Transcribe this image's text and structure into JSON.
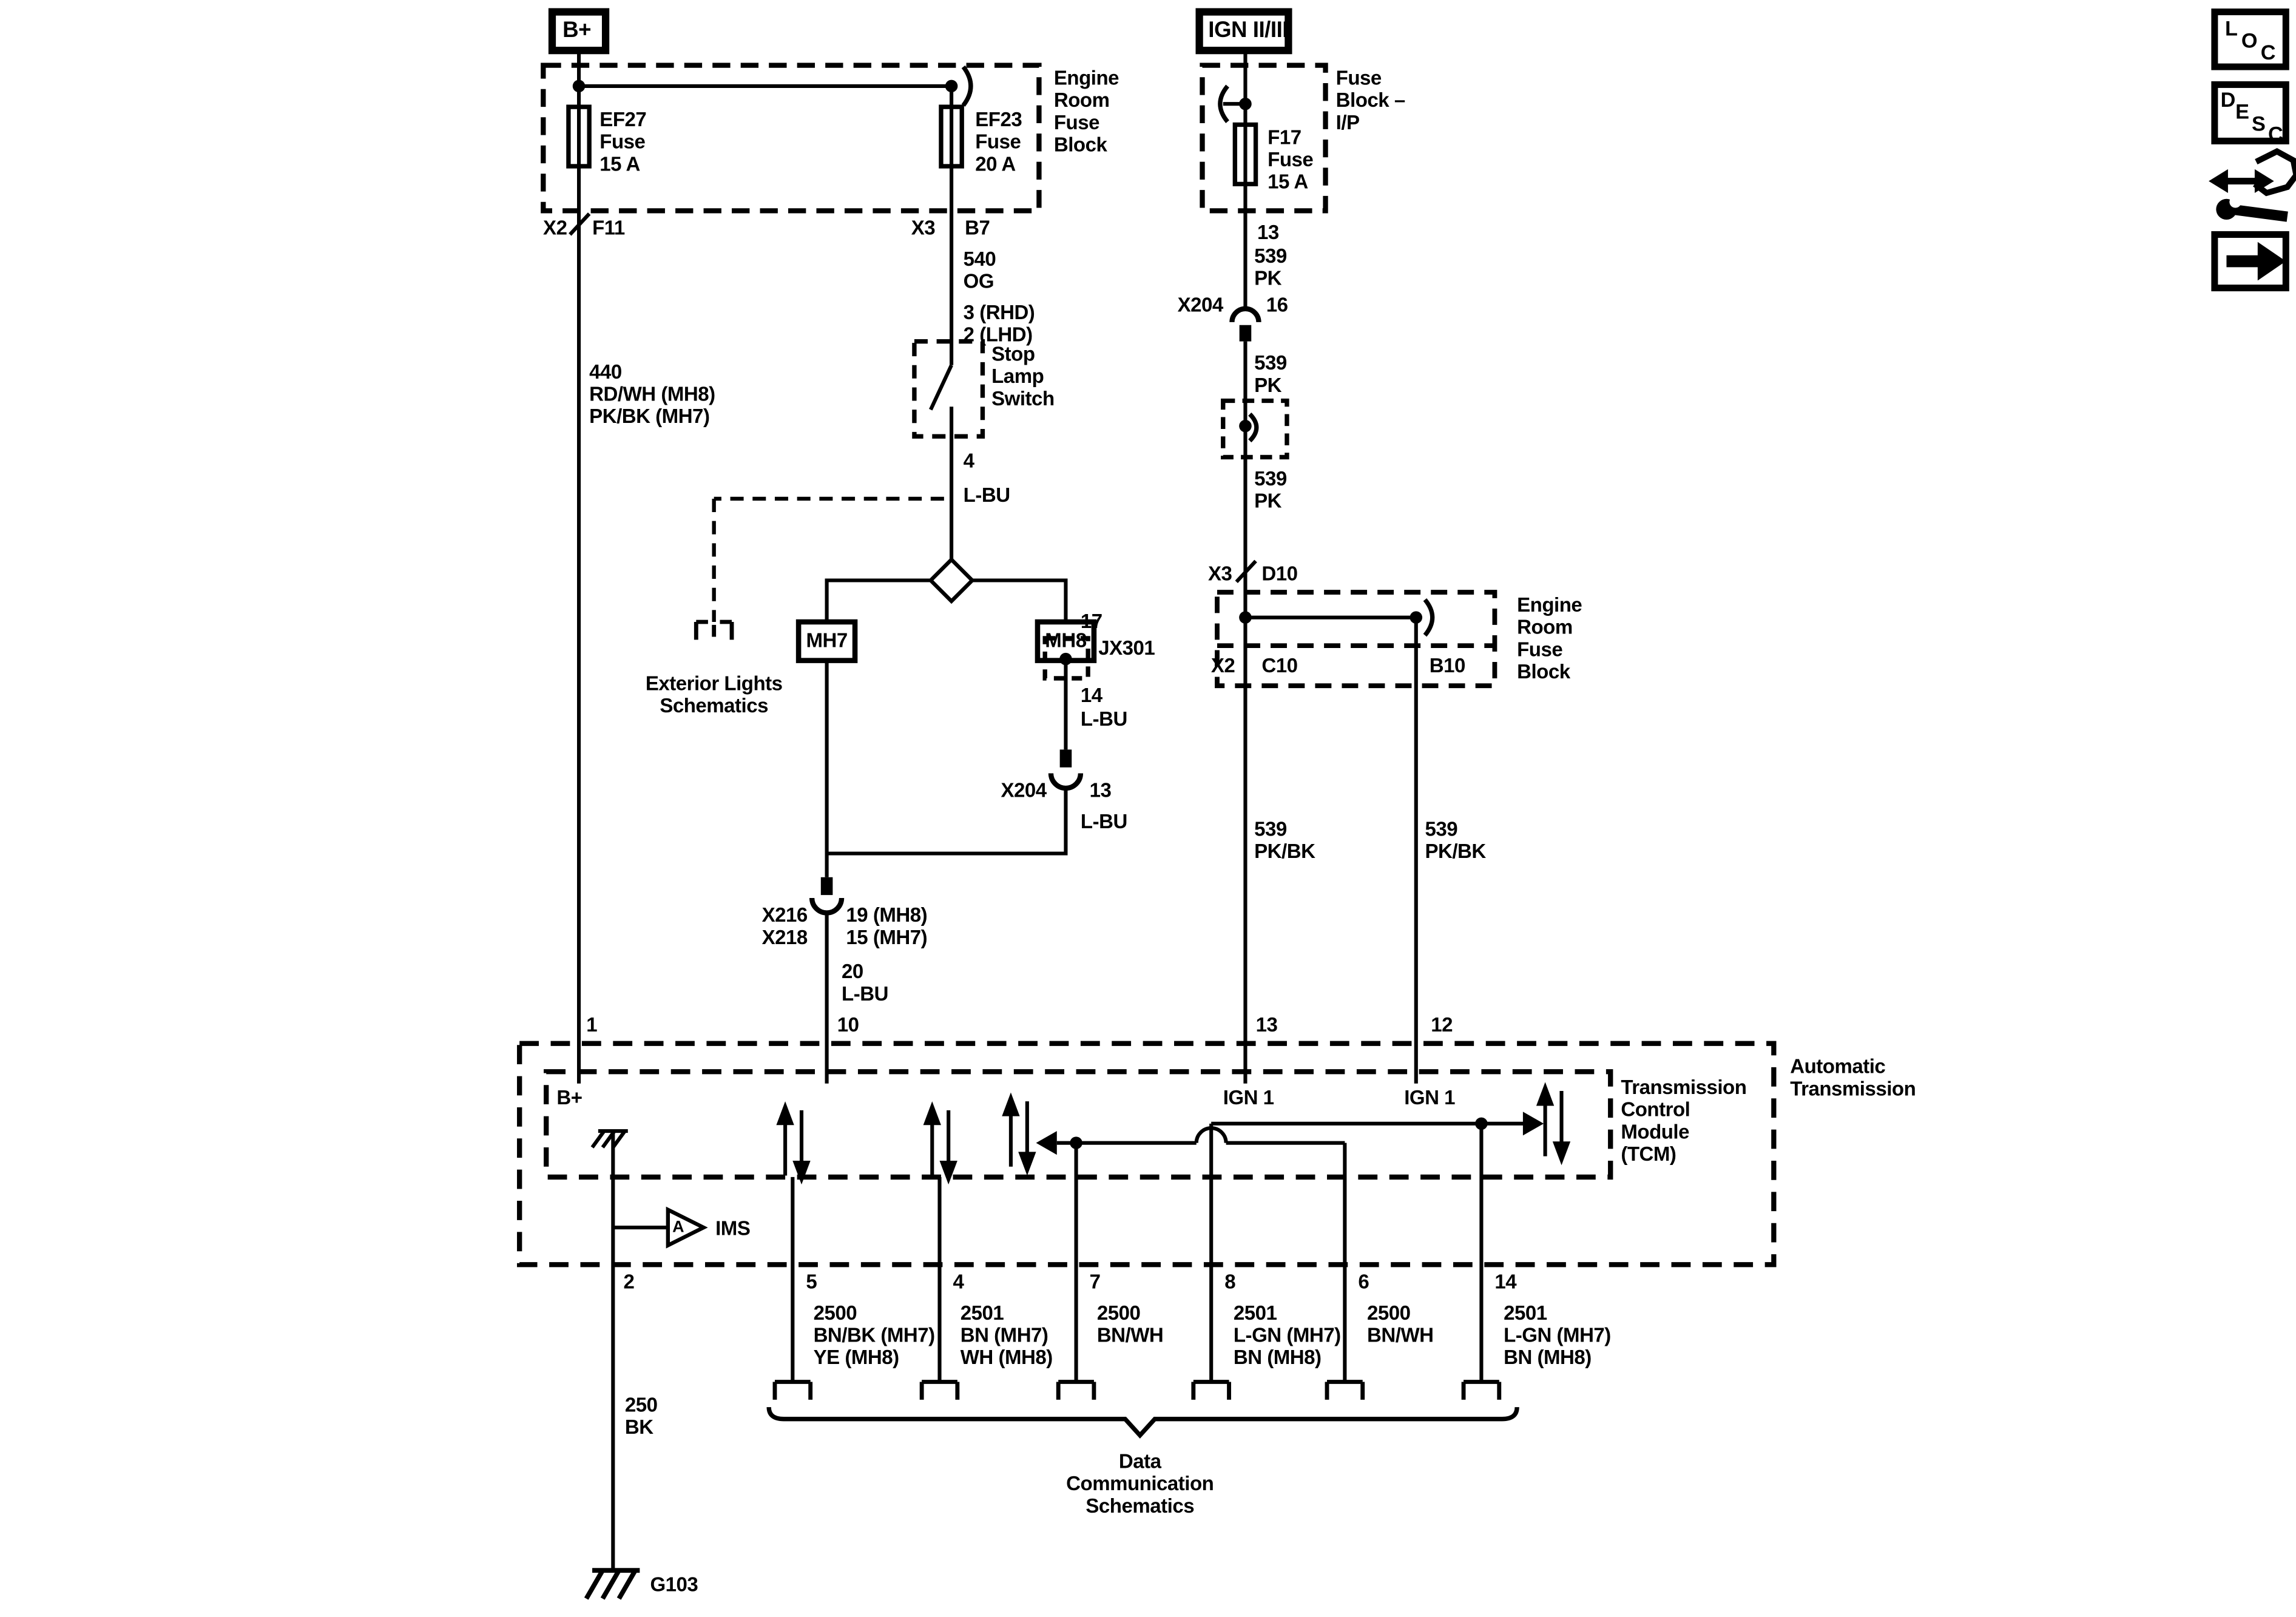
{
  "colors": {
    "line": "#000000",
    "background": "#ffffff"
  },
  "power": {
    "b_plus": "B+",
    "ign": "IGN II/III"
  },
  "engine_room_fuse_block_top": {
    "name": "Engine\nRoom\nFuse\nBlock",
    "ef27": "EF27\nFuse\n15 A",
    "ef23": "EF23\nFuse\n20 A",
    "x2": "X2",
    "f11": "F11",
    "x3": "X3",
    "b7": "B7"
  },
  "fuse_block_ip": {
    "name": "Fuse\nBlock –\nI/P",
    "f17": "F17\nFuse\n15 A",
    "pin13": "13",
    "wire539pk_a": "539\nPK",
    "x204": "X204",
    "pin16": "16",
    "wire539pk_b": "539\nPK",
    "wire539pk_c": "539\nPK",
    "x3": "X3",
    "d10": "D10"
  },
  "engine_room_fuse_block_right": {
    "name": "Engine\nRoom\nFuse\nBlock",
    "x2": "X2",
    "c10": "C10",
    "b10": "B10",
    "wire539pkbk_left": "539\nPK/BK",
    "wire539pkbk_right": "539\nPK/BK"
  },
  "stop_lamp_branch": {
    "wire540": "540\nOG",
    "variant": "3 (RHD)\n2 (LHD)",
    "switch": "Stop\nLamp\nSwitch",
    "pin4": "4",
    "lbu1": "L-BU",
    "exterior": "Exterior Lights\nSchematics",
    "mh7": "MH7",
    "mh8": "MH8",
    "pin17": "17",
    "jx301": "JX301",
    "pin14": "14",
    "lbu2": "L-BU",
    "x204": "X204",
    "pin13": "13",
    "lbu3": "L-BU",
    "x216_x218": "X216\nX218",
    "pins_mh": "19 (MH8)\n15 (MH7)",
    "wire20": "20\nL-BU",
    "pin10": "10"
  },
  "left_feed": {
    "wire440": "440\nRD/WH (MH8)\nPK/BK (MH7)",
    "pin1": "1"
  },
  "tcm": {
    "outer_name": "Automatic\nTransmission",
    "inner_name": "Transmission\nControl\nModule\n(TCM)",
    "b_plus_pin": "B+",
    "ign1_left": "IGN 1",
    "ign1_right": "IGN 1",
    "pin13": "13",
    "pin12": "12",
    "ims_gate": "A",
    "ims": "IMS"
  },
  "bottom_pins": {
    "pin2": "2",
    "pin5": "5",
    "pin4": "4",
    "pin7": "7",
    "pin8": "8",
    "pin6": "6",
    "pin14": "14",
    "c5": "2500\nBN/BK (MH7)\nYE (MH8)",
    "c4": "2501\nBN (MH7)\nWH (MH8)",
    "c7": "2500\nBN/WH",
    "c8": "2501\nL-GN (MH7)\nBN (MH8)",
    "c6": "2500\nBN/WH",
    "c14": "2501\nL-GN (MH7)\nBN (MH8)",
    "wire250": "250\nBK",
    "g103": "G103",
    "data_comm": "Data\nCommunication\nSchematics"
  },
  "nav_icons": {
    "loc_l": "L",
    "loc_o": "O",
    "loc_c": "C",
    "desc_d": "D",
    "desc_e": "E",
    "desc_s": "S",
    "desc_c": "C"
  }
}
